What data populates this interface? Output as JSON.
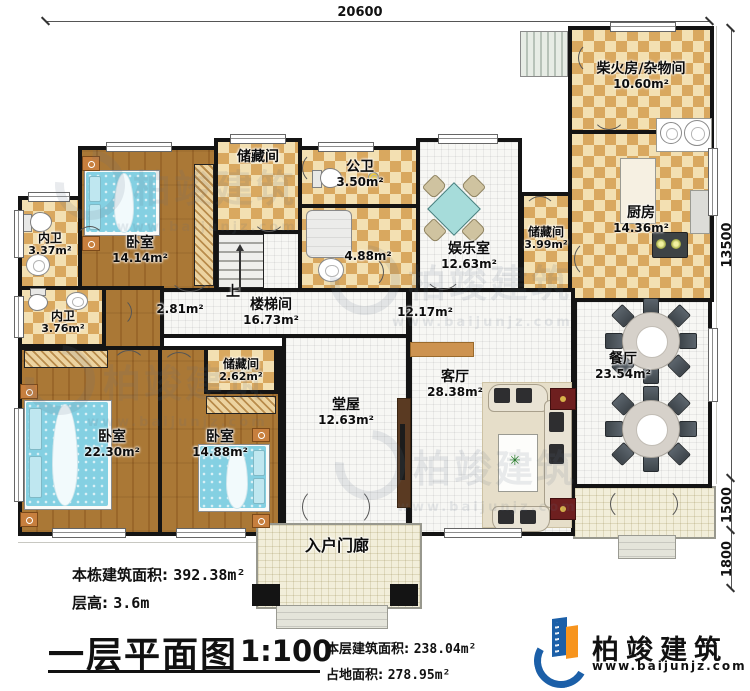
{
  "dimensions": {
    "top": "20600",
    "right_upper": "13500",
    "right_mid": "1500",
    "right_lower": "1800"
  },
  "rooms": {
    "chaihuofang": {
      "name": "柴火房/杂物间",
      "area": "10.60m²"
    },
    "kitchen": {
      "name": "厨房",
      "area": "14.36m²"
    },
    "storage_right": {
      "name": "储藏间",
      "area": "3.99m²"
    },
    "dining": {
      "name": "餐厅",
      "area": "23.54m²"
    },
    "entertainment": {
      "name": "娱乐室",
      "area": "12.63m²"
    },
    "gongwei": {
      "name": "公卫",
      "area": "3.50m²"
    },
    "bath": {
      "area": "4.88m²"
    },
    "storage_top": {
      "name": "储藏间"
    },
    "bedroom_tl": {
      "name": "卧室",
      "area": "14.14m²"
    },
    "neiwei_top": {
      "name": "内卫",
      "area": "3.37m²"
    },
    "neiwei_mid": {
      "name": "内卫",
      "area": "3.76m²"
    },
    "stairwell": {
      "name": "楼梯间",
      "area": "16.73m²",
      "up_label": "上",
      "side_area": "2.81m²"
    },
    "corridor": {
      "area": "12.17m²"
    },
    "storage_small": {
      "name": "储藏间",
      "area": "2.62m²"
    },
    "bedroom_bl": {
      "name": "卧室",
      "area": "22.30m²"
    },
    "bedroom_bm": {
      "name": "卧室",
      "area": "14.88m²"
    },
    "tangwu": {
      "name": "堂屋",
      "area": "12.63m²"
    },
    "living": {
      "name": "客厅",
      "area": "28.38m²"
    },
    "porch": {
      "name": "入户门廊"
    }
  },
  "title_block": {
    "building_area_label": "本栋建筑面积:",
    "building_area_value": "392.38m²",
    "floor_height_label": "层高:",
    "floor_height_value": "3.6m",
    "plan_title": "一层平面图",
    "scale": "1:100",
    "floor_area_label": "本层建筑面积:",
    "floor_area_value": "238.04m²",
    "footprint_label": "占地面积:",
    "footprint_value": "278.95m²"
  },
  "brand": {
    "name": "柏竣建筑",
    "url": "www.baijunjz.com"
  },
  "watermark": {
    "name": "柏竣建筑",
    "url": "www.baijunjz.com"
  },
  "colors": {
    "wall": "#141414",
    "checker_dark": "#d9a85f",
    "checker_light": "#f3e0b2",
    "wood_floor": "#a5722d",
    "bed_blue": "#84d0e2",
    "brand_orange": "#f7941d",
    "brand_blue": "#1b5fa8"
  }
}
